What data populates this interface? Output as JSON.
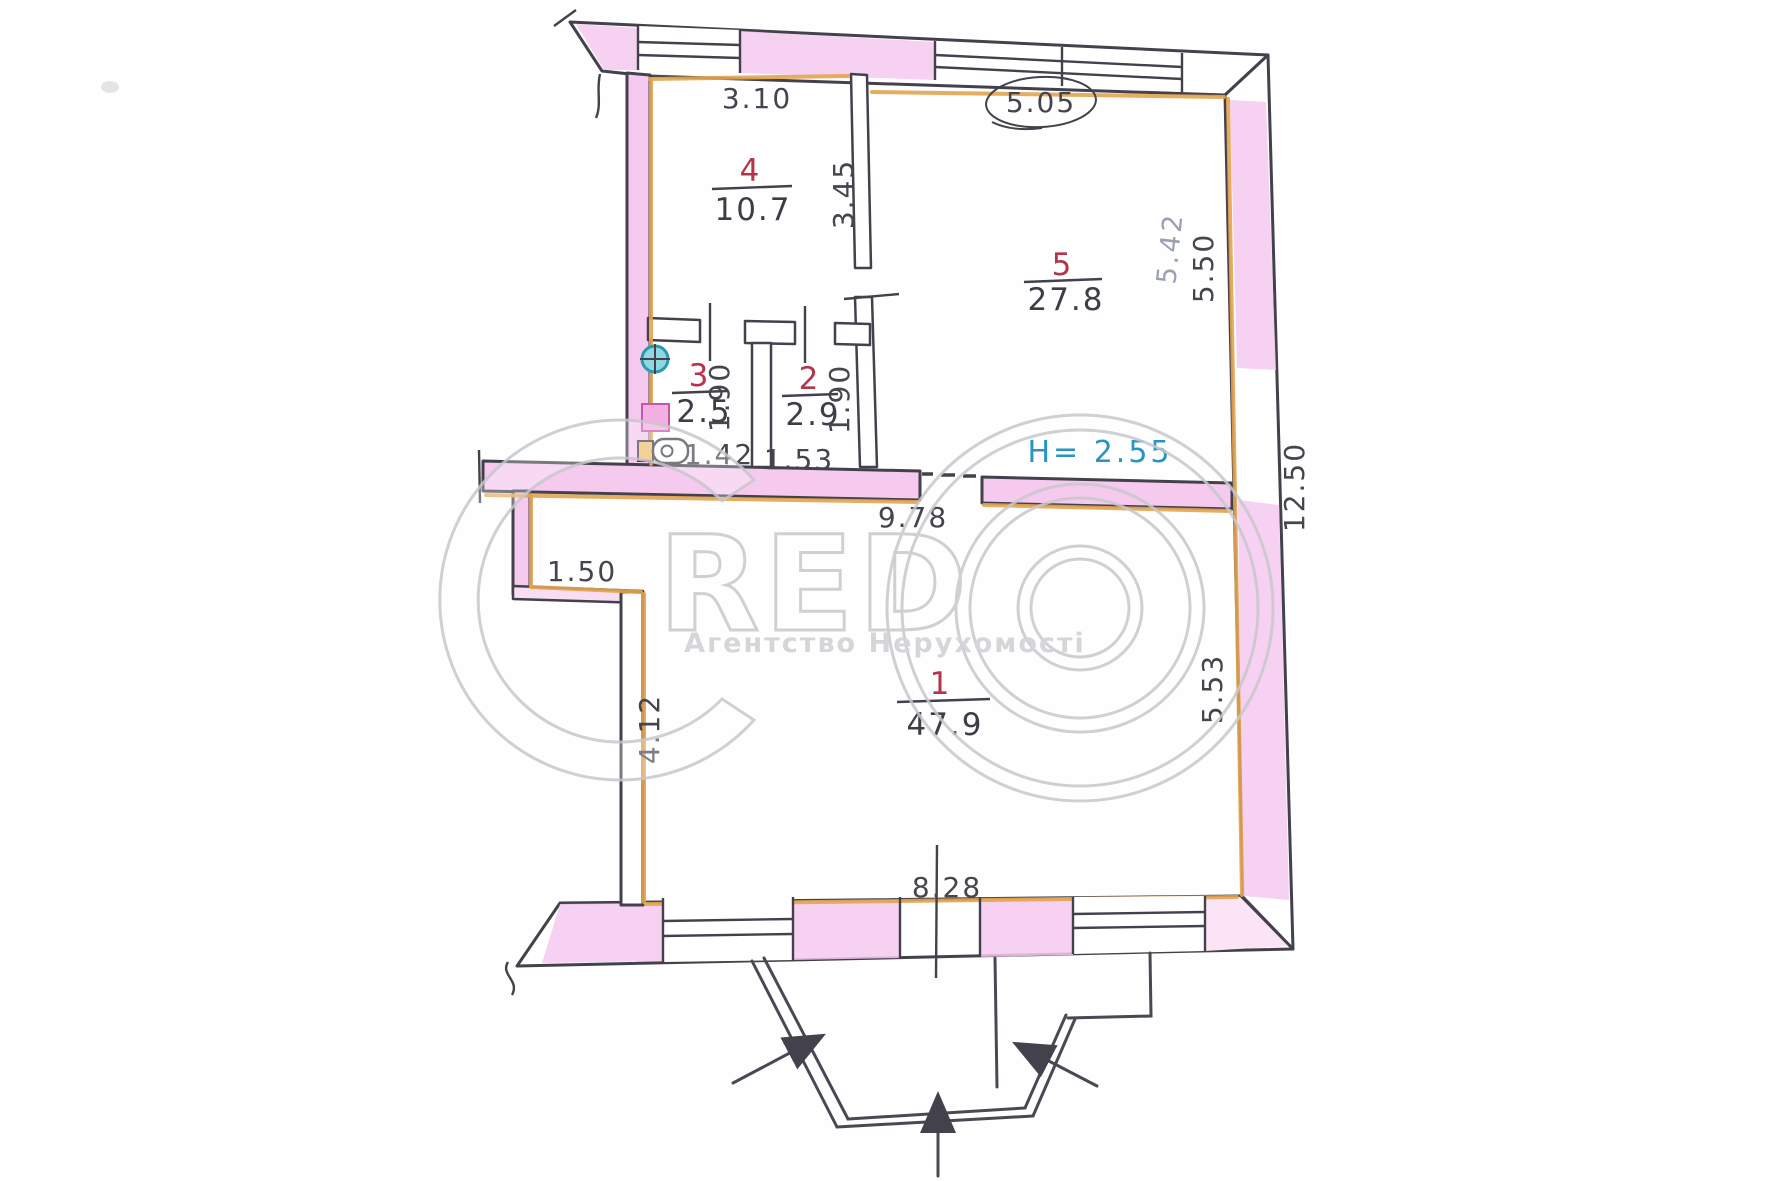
{
  "document": {
    "kind": "apartment floor plan (scanned hand-drawn BTI plan)",
    "height_note": "H= 2.55"
  },
  "rooms": [
    {
      "number": "1",
      "area": "47.9"
    },
    {
      "number": "2",
      "area": "2.9"
    },
    {
      "number": "3",
      "area": "2.5"
    },
    {
      "number": "4",
      "area": "10.7"
    },
    {
      "number": "5",
      "area": "27.8"
    }
  ],
  "dimensions": {
    "room4_width": "3.10",
    "room4_depth": "3.45",
    "room5_width": "5.05",
    "room5_depth": "5.50",
    "room5_pencil": "5.42",
    "room3_width": "1.42",
    "room3_depth": "1.90",
    "room2_width": "1.53",
    "room2_depth": "1.90",
    "hall_width": "9.78",
    "notch": "1.50",
    "room1_left": "4.12",
    "room1_right": "5.53",
    "room1_width": "8.28",
    "building_depth": "12.50",
    "ceiling_height": "H= 2.55"
  },
  "watermark": {
    "brand": "CREDO",
    "letter_c": "C",
    "letters_red": "RED",
    "tagline": "Агентство Нерухомості"
  },
  "colors": {
    "wall_ink": "#43414b",
    "wall_highlight_pink": "#f6c9ee",
    "interior_highlight_orange": "#e2a44f",
    "room_number_red": "#b5344a",
    "height_note_blue": "#2794c4",
    "pencil_grey": "#9aa0b2",
    "watermark_grey": "#c8c8cc",
    "sink_teal": "#8fd8e0"
  }
}
